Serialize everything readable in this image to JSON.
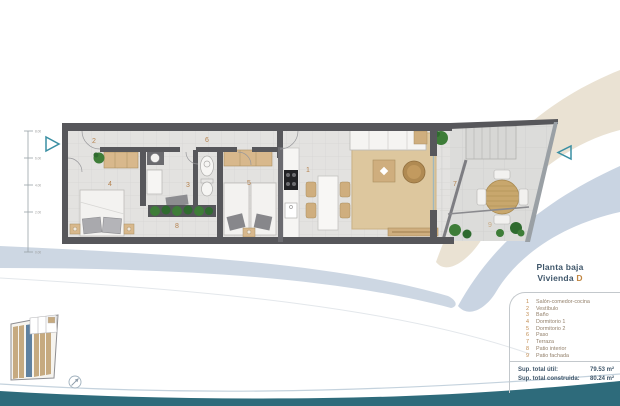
{
  "plan_labels": {
    "r1": "1",
    "r2": "2",
    "r3": "3",
    "r4": "4",
    "r5": "5",
    "r6": "6",
    "r7": "7",
    "r8": "8",
    "r9": "9"
  },
  "dims": {
    "t0": "8.00",
    "t1": "6.00",
    "t2": "4.00",
    "t3": "2.00",
    "t4": "0.00"
  },
  "legend": {
    "title": "Planta baja",
    "unit_label": "Vivienda",
    "unit_value": "D",
    "rooms": [
      {
        "num": "1",
        "name": "Salón-comedor-cocina"
      },
      {
        "num": "2",
        "name": "Vestíbulo"
      },
      {
        "num": "3",
        "name": "Baño"
      },
      {
        "num": "4",
        "name": "Dormitorio 1"
      },
      {
        "num": "5",
        "name": "Dormitorio 2"
      },
      {
        "num": "6",
        "name": "Paso"
      },
      {
        "num": "7",
        "name": "Terraza"
      },
      {
        "num": "8",
        "name": "Patio interior"
      },
      {
        "num": "9",
        "name": "Patio fachada"
      }
    ],
    "totals": {
      "util_label": "Sup. total útil:",
      "util_value": "79.53 m²",
      "built_label": "Sup. total construida:",
      "built_value": "80.24 m²"
    }
  },
  "colors": {
    "accent_orange": "#c08540",
    "navy_text": "#40576b",
    "teal_wave": "#2e6b7b",
    "teal_arrow": "#3a8fa3",
    "unit_highlight": "#5f81a0",
    "site_tan": "#c6aa80"
  }
}
